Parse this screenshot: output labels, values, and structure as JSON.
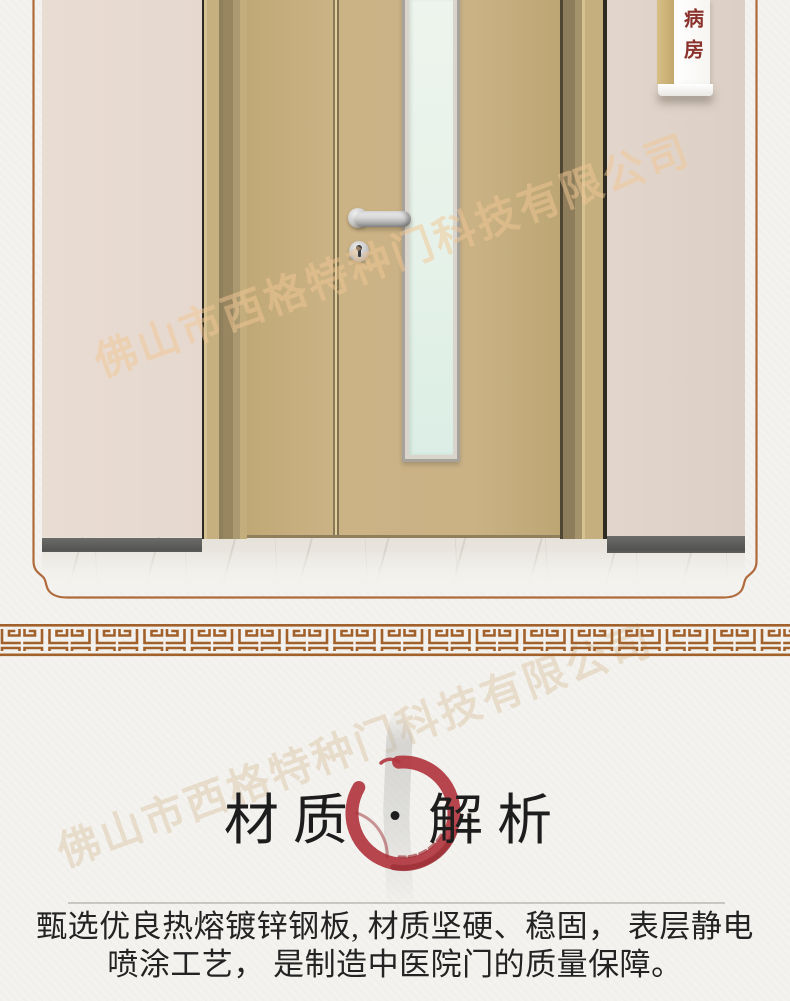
{
  "page": {
    "background": "#f3f2ee"
  },
  "photo": {
    "sign": {
      "label": "病房",
      "text_color": "#8c322c"
    },
    "colors": {
      "wall_left": "#e7dacf",
      "wall_right": "#e2d5cb",
      "door_leaf": "#c9b183",
      "frame_tan": "#c3ad7c",
      "frame_olive": "#97865f",
      "glass": "#e8f2e9",
      "baseboard": "#595957",
      "marble_floor": "#eae7e1",
      "handle_silver": "#c9c9c9"
    }
  },
  "watermark": {
    "text": "佛山市西格特种门科技有限公司",
    "photo_color": "#f2c795",
    "paper_color": "#d9c09c"
  },
  "decor": {
    "border_color": "#b06a3c",
    "meander_color": "#a2602a",
    "divider_color": "#cac7c3"
  },
  "title": {
    "left": "材质",
    "separator": "·",
    "right": "解析",
    "text_color": "#1d1d1d",
    "enso_color": "#b1363f",
    "enso_dark": "#9c2f36",
    "drip_color": "#c8c8c6"
  },
  "body": {
    "line1": "甄选优良热熔镀锌钢板, 材质坚硬、稳固， 表层静电",
    "line2": "喷涂工艺， 是制造中医院门的质量保障。",
    "text_color": "#232323"
  }
}
